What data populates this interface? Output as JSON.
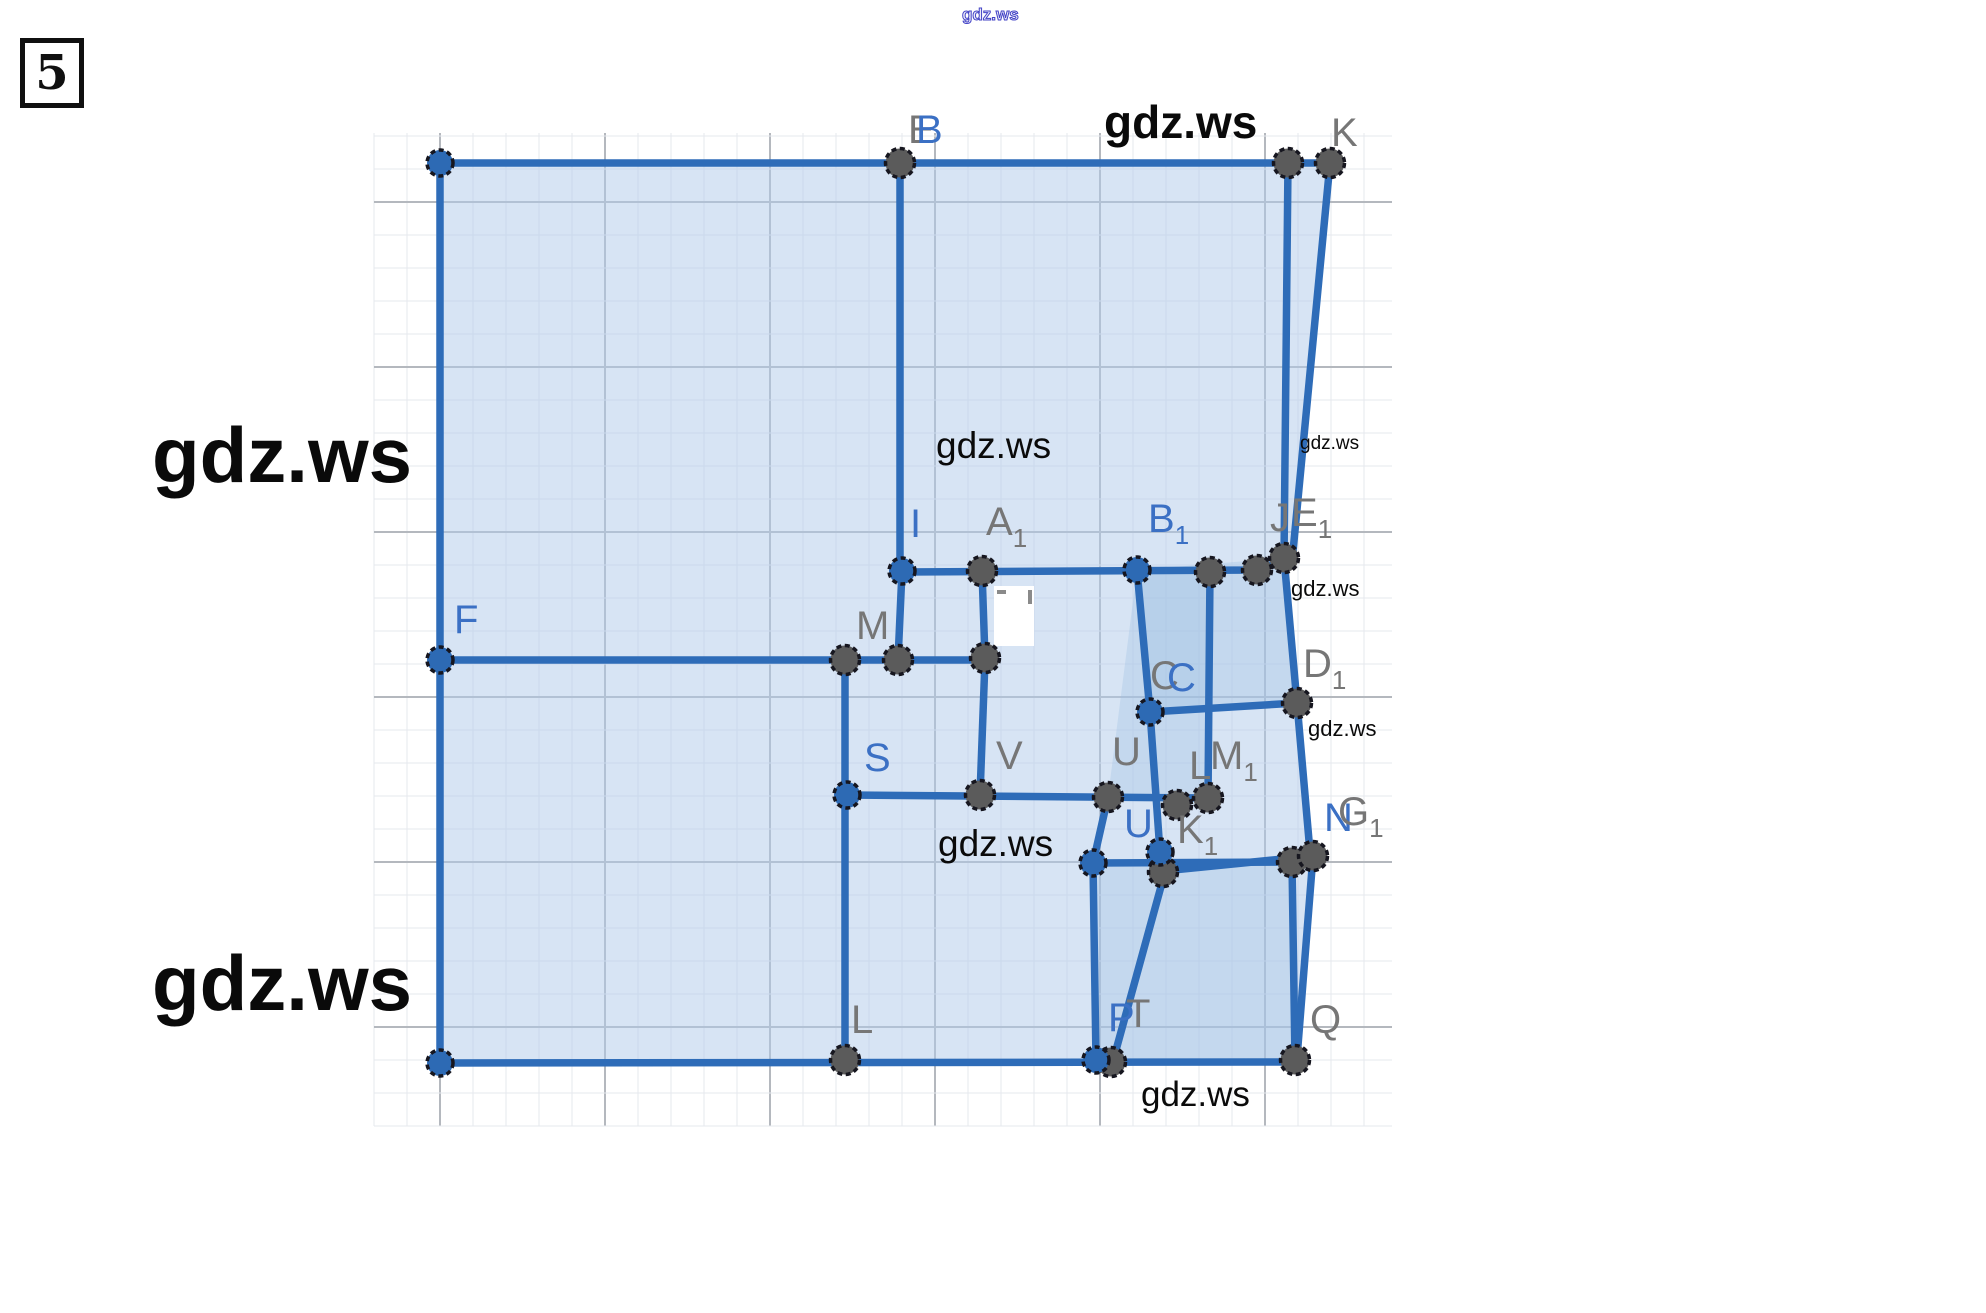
{
  "page": {
    "badge": "5"
  },
  "figure": {
    "grid": {
      "x0": 374,
      "y0": 133,
      "x1": 1392,
      "y1": 1126,
      "step": 33,
      "major_every": 5,
      "ox": 440,
      "oy": 202,
      "fine_color": "#e6e9ee",
      "major_color": "#b4b8be"
    },
    "colors": {
      "edge": "#2e6cb8",
      "point_blue": "#2d6ab4",
      "point_gray": "#5b5b5b",
      "ring": "#16161f",
      "label_gray": "#767676",
      "label_blue": "#3b70c4",
      "fill_base": "rgba(176,202,234,0.50)",
      "fill_overlay": "rgba(158,190,228,0.33)",
      "watermark": "#0a0a0a",
      "watermark_outline": "#4343c6"
    },
    "polygons": [
      {
        "name": "main-square-fill",
        "fill": "base",
        "pts": [
          [
            440,
            163
          ],
          [
            1288,
            163
          ],
          [
            1284,
            558
          ],
          [
            1297,
            703
          ],
          [
            1310,
            852
          ],
          [
            1295,
            1060
          ],
          [
            440,
            1060
          ]
        ]
      },
      {
        "name": "right-sliver-fill",
        "fill": "base",
        "pts": [
          [
            1288,
            163
          ],
          [
            1330,
            163
          ],
          [
            1292,
            562
          ],
          [
            1284,
            558
          ]
        ]
      },
      {
        "name": "mid-square-overlay",
        "fill": "overlay",
        "pts": [
          [
            1137,
            570
          ],
          [
            1284,
            558
          ],
          [
            1297,
            703
          ],
          [
            1150,
            712
          ]
        ]
      },
      {
        "name": "bottom-right-square-overlay",
        "fill": "overlay",
        "pts": [
          [
            1096,
            862
          ],
          [
            1292,
            862
          ],
          [
            1295,
            1060
          ],
          [
            1098,
            1060
          ]
        ]
      },
      {
        "name": "u-square-overlay",
        "fill": "overlay",
        "pts": [
          [
            1137,
            570
          ],
          [
            1210,
            572
          ],
          [
            1208,
            798
          ],
          [
            1108,
            797
          ]
        ]
      }
    ],
    "segments": [
      [
        [
          440,
          163
        ],
        [
          1330,
          163
        ]
      ],
      [
        [
          440,
          163
        ],
        [
          440,
          1063
        ]
      ],
      [
        [
          440,
          1063
        ],
        [
          1295,
          1062
        ]
      ],
      [
        [
          1288,
          163
        ],
        [
          1284,
          558
        ]
      ],
      [
        [
          1330,
          163
        ],
        [
          1292,
          562
        ]
      ],
      [
        [
          1284,
          558
        ],
        [
          1297,
          703
        ]
      ],
      [
        [
          1297,
          703
        ],
        [
          1310,
          852
        ]
      ],
      [
        [
          900,
          163
        ],
        [
          900,
          571
        ]
      ],
      [
        [
          902,
          571
        ],
        [
          898,
          660
        ]
      ],
      [
        [
          902,
          572
        ],
        [
          1257,
          570
        ],
        [
          1284,
          560
        ]
      ],
      [
        [
          440,
          660
        ],
        [
          985,
          660
        ]
      ],
      [
        [
          982,
          571
        ],
        [
          985,
          658
        ]
      ],
      [
        [
          845,
          660
        ],
        [
          845,
          1062
        ]
      ],
      [
        [
          985,
          660
        ],
        [
          980,
          795
        ]
      ],
      [
        [
          847,
          795
        ],
        [
          1210,
          798
        ]
      ],
      [
        [
          1137,
          570
        ],
        [
          1150,
          712
        ],
        [
          1160,
          852
        ]
      ],
      [
        [
          1210,
          572
        ],
        [
          1208,
          798
        ]
      ],
      [
        [
          1150,
          712
        ],
        [
          1297,
          703
        ]
      ],
      [
        [
          1108,
          797
        ],
        [
          1093,
          863
        ],
        [
          1096,
          1060
        ]
      ],
      [
        [
          1093,
          863
        ],
        [
          1292,
          862
        ]
      ],
      [
        [
          1160,
          852
        ],
        [
          1165,
          872
        ],
        [
          1113,
          1061
        ]
      ],
      [
        [
          1163,
          871
        ],
        [
          1313,
          856
        ]
      ],
      [
        [
          1292,
          862
        ],
        [
          1295,
          1060
        ]
      ],
      [
        [
          1313,
          856
        ],
        [
          1297,
          1058
        ]
      ]
    ],
    "points": {
      "blue": [
        [
          440,
          163
        ],
        [
          902,
          571
        ],
        [
          1137,
          570
        ],
        [
          1150,
          712
        ],
        [
          440,
          660
        ],
        [
          847,
          795
        ],
        [
          1093,
          863
        ],
        [
          1160,
          852
        ],
        [
          440,
          1063
        ],
        [
          1096,
          1060
        ]
      ],
      "gray": [
        [
          900,
          163
        ],
        [
          1288,
          163
        ],
        [
          1330,
          163
        ],
        [
          982,
          571
        ],
        [
          1210,
          572
        ],
        [
          1257,
          570
        ],
        [
          1284,
          558
        ],
        [
          845,
          660
        ],
        [
          898,
          660
        ],
        [
          985,
          658
        ],
        [
          1297,
          703
        ],
        [
          980,
          795
        ],
        [
          1108,
          797
        ],
        [
          1177,
          805
        ],
        [
          1208,
          798
        ],
        [
          1163,
          872
        ],
        [
          1292,
          862
        ],
        [
          1313,
          856
        ],
        [
          845,
          1060
        ],
        [
          1111,
          1062
        ],
        [
          1295,
          1060
        ]
      ]
    },
    "labels": [
      {
        "t": "E",
        "x": 908,
        "y": 143,
        "c": "gray"
      },
      {
        "t": "B",
        "x": 916,
        "y": 143,
        "c": "blue"
      },
      {
        "t": "K",
        "x": 1331,
        "y": 146,
        "c": "gray"
      },
      {
        "t": "I",
        "x": 910,
        "y": 537,
        "c": "blue"
      },
      {
        "t": "A",
        "sub": "1",
        "x": 986,
        "y": 535,
        "c": "gray"
      },
      {
        "t": "B",
        "sub": "1",
        "x": 1148,
        "y": 532,
        "c": "blue"
      },
      {
        "t": "J",
        "x": 1270,
        "y": 531,
        "c": "gray"
      },
      {
        "t": "E",
        "sub": "1",
        "x": 1291,
        "y": 526,
        "c": "gray"
      },
      {
        "t": "F",
        "x": 454,
        "y": 633,
        "c": "blue"
      },
      {
        "t": "M",
        "x": 856,
        "y": 639,
        "c": "gray"
      },
      {
        "t": "C",
        "x": 1150,
        "y": 689,
        "c": "gray"
      },
      {
        "t": "C",
        "x": 1167,
        "y": 691,
        "c": "blue"
      },
      {
        "t": "D",
        "sub": "1",
        "x": 1303,
        "y": 677,
        "c": "gray"
      },
      {
        "t": "S",
        "x": 864,
        "y": 771,
        "c": "blue"
      },
      {
        "t": "V",
        "x": 996,
        "y": 769,
        "c": "gray"
      },
      {
        "t": "U",
        "x": 1112,
        "y": 765,
        "c": "gray"
      },
      {
        "t": "L",
        "x": 1189,
        "y": 779,
        "c": "gray"
      },
      {
        "t": "M",
        "sub": "1",
        "x": 1210,
        "y": 769,
        "c": "gray"
      },
      {
        "t": "U",
        "x": 1124,
        "y": 837,
        "c": "blue"
      },
      {
        "t": "K",
        "sub": "1",
        "x": 1177,
        "y": 843,
        "c": "gray"
      },
      {
        "t": "N",
        "x": 1324,
        "y": 831,
        "c": "blue"
      },
      {
        "t": "G",
        "sub": "1",
        "x": 1338,
        "y": 825,
        "c": "gray"
      },
      {
        "t": "L",
        "x": 851,
        "y": 1033,
        "c": "gray"
      },
      {
        "t": "P",
        "x": 1108,
        "y": 1031,
        "c": "blue"
      },
      {
        "t": "T",
        "x": 1126,
        "y": 1027,
        "c": "gray"
      },
      {
        "t": "Q",
        "x": 1310,
        "y": 1033,
        "c": "gray"
      }
    ],
    "white_patch": {
      "x": 994,
      "y": 586,
      "w": 40,
      "h": 60
    },
    "patch_marks": [
      [
        997,
        592,
        1006,
        592
      ],
      [
        1030,
        590,
        1030,
        604
      ]
    ],
    "watermarks": [
      {
        "t": "gdz.ws",
        "x": 962,
        "y": 20,
        "size": 17,
        "weight": 600,
        "style": "outline"
      },
      {
        "t": "gdz.ws",
        "x": 1104,
        "y": 138,
        "size": 46,
        "weight": 600,
        "style": "solid"
      },
      {
        "t": "gdz.ws",
        "x": 152,
        "y": 482,
        "size": 78,
        "weight": 600,
        "style": "solid"
      },
      {
        "t": "gdz.ws",
        "x": 152,
        "y": 1010,
        "size": 78,
        "weight": 600,
        "style": "solid"
      },
      {
        "t": "gdz.ws",
        "x": 936,
        "y": 458,
        "size": 37,
        "weight": 500,
        "style": "solid"
      },
      {
        "t": "gdz.ws",
        "x": 938,
        "y": 856,
        "size": 37,
        "weight": 500,
        "style": "solid"
      },
      {
        "t": "gdz.ws",
        "x": 1300,
        "y": 449,
        "size": 19,
        "weight": 500,
        "style": "solid"
      },
      {
        "t": "gdz.ws",
        "x": 1291,
        "y": 596,
        "size": 22,
        "weight": 500,
        "style": "solid"
      },
      {
        "t": "gdz.ws",
        "x": 1308,
        "y": 736,
        "size": 22,
        "weight": 500,
        "style": "solid"
      },
      {
        "t": "gdz.ws",
        "x": 1141,
        "y": 1106,
        "size": 35,
        "weight": 500,
        "style": "solid"
      }
    ]
  }
}
